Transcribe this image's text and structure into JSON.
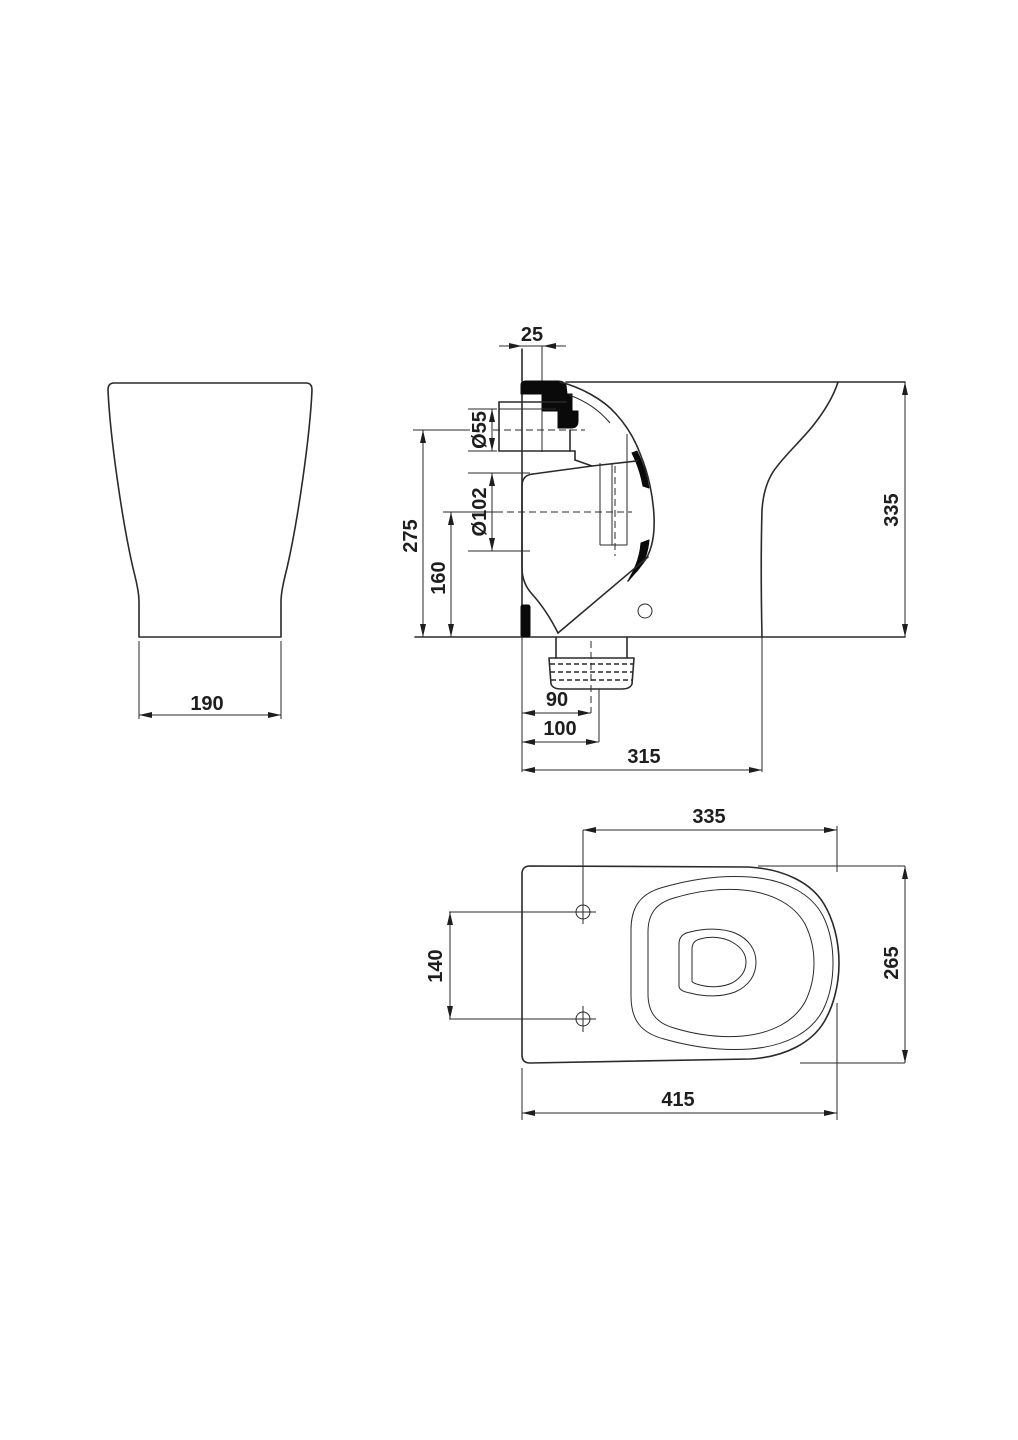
{
  "drawing": {
    "type": "technical-dimension-drawing",
    "subject": "back-to-wall toilet pan, three orthographic views",
    "background": "#ffffff",
    "line_color": "#2a2a2a",
    "views": {
      "front": {
        "dim_base_width": "190"
      },
      "side": {
        "dim_wall_offset": "25",
        "dim_inlet_diameter": "Ø55",
        "dim_outlet_diameter": "Ø102",
        "dim_inlet_center_height": "275",
        "dim_outlet_center_height": "160",
        "dim_overall_height": "335",
        "dim_outlet_center_depth": "90",
        "dim_outlet_front_depth": "100",
        "dim_overall_depth": "315"
      },
      "plan": {
        "dim_bowl_depth": "335",
        "dim_fixing_hole_spacing": "140",
        "dim_overall_width": "265",
        "dim_overall_depth": "415"
      }
    }
  }
}
